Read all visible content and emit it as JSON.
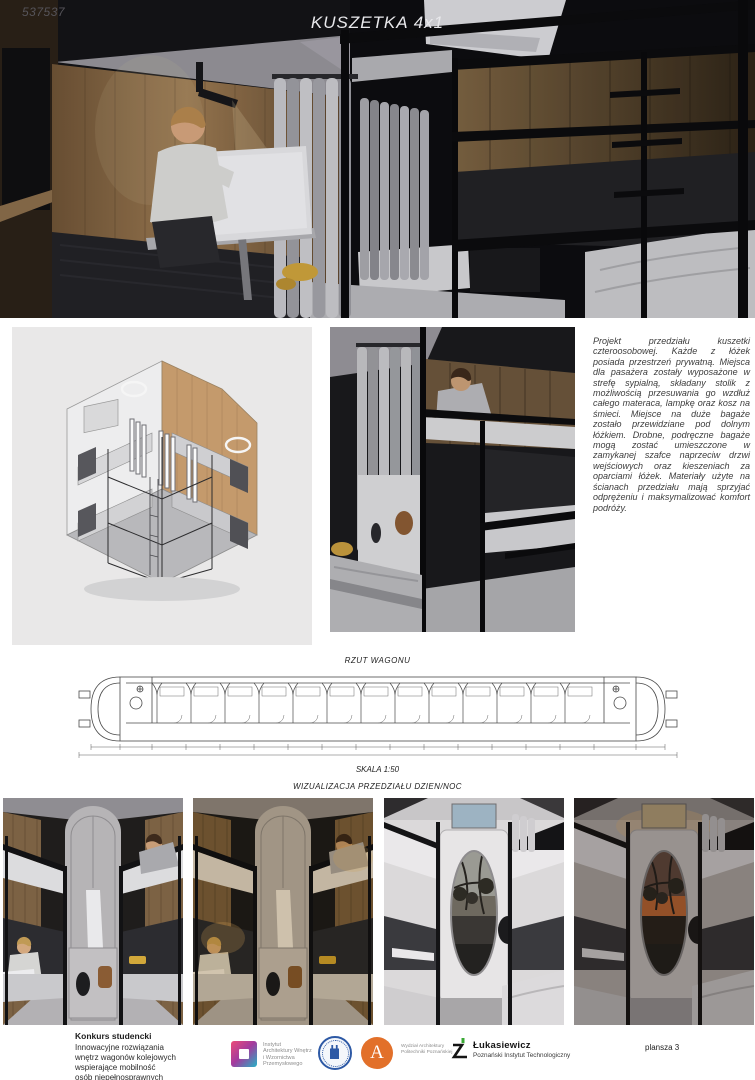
{
  "hero": {
    "entry_number": "537537",
    "title": "KUSZETKA 4x1"
  },
  "middle": {
    "axonometry_label": "AKSONOMETRIA",
    "description": "Projekt przedziału kuszetki czteroosobowej. Każde z łóżek posiada przestrzeń prywatną. Miejsca dla pasażera zostały wyposażone w strefę sypialną, składany stolik z możliwością przesuwania go wzdłuż całego materaca, lampkę oraz kosz na śmieci. Miejsce na duże bagaże zostało przewidziane pod dolnym łóżkiem. Drobne, podręczne bagaże mogą zostać umieszczone w zamykanej szafce naprzeciw drzwi wejściowych oraz kieszeniach za oparciami łóżek. Materiały użyte na ścianach przedziału mają sprzyjać odprężeniu i maksymalizować komfort podróży."
  },
  "plan": {
    "title": "RZUT WAGONU",
    "scale": "SKALA 1:50"
  },
  "viz": {
    "title": "WIZUALIZACJA PRZEDZIAŁU DZIEN/NOC"
  },
  "footer": {
    "competition_title": "Konkurs studencki",
    "competition_lines": [
      "Innowacyjne rozwiązania",
      "wnętrz wagonów kolejowych",
      "wspierające mobilność",
      "osób niepełnosprawnych"
    ],
    "iawiwp_lines": [
      "Instytut",
      "Architektury Wnętrz",
      "i Wzornictwa",
      "Przemysłowego"
    ],
    "architecture_letter": "A",
    "wa_lines": [
      "Wydział Architektury",
      "Politechniki Poznańskiej"
    ],
    "lukasiewicz_name": "Łukasiewicz",
    "lukasiewicz_subtitle": "Poznański Instytut Technologiczny",
    "board_label": "plansza 3"
  },
  "colors": {
    "hero_bg": "#141417",
    "panel_bg": "#e9e8e8",
    "wood": "#8a6f4f",
    "frame_black": "#121212",
    "iawiwp_gradient": [
      "#ec4b78",
      "#a23a9e",
      "#25b2c6"
    ],
    "seal_blue": "#2d59a5",
    "architecture_orange": "#e2702a",
    "lukasiewicz_green": "#3aa935"
  }
}
